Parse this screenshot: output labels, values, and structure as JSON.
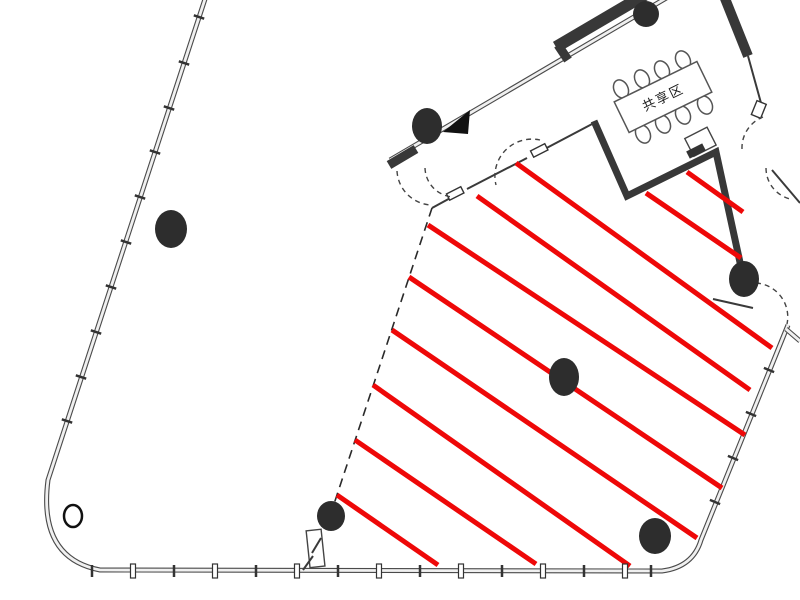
{
  "labels": {
    "shared_area": "共享区"
  },
  "colors": {
    "hatch_red": "#ee0808",
    "wall_dark": "#383838",
    "line_gray": "#4a4a4a",
    "column_fill": "#2d2d2d",
    "tick": "#333333"
  },
  "hatch_region": {
    "line_width": 5,
    "lines": [
      [
        687,
        172,
        743,
        212
      ],
      [
        646,
        193,
        741,
        258
      ],
      [
        516,
        163,
        772,
        348
      ],
      [
        477,
        196,
        750,
        390
      ],
      [
        428,
        225,
        745,
        435
      ],
      [
        409,
        277,
        722,
        488
      ],
      [
        392,
        330,
        697,
        538
      ],
      [
        373,
        385,
        630,
        566
      ],
      [
        355,
        440,
        536,
        564
      ],
      [
        337,
        495,
        438,
        565
      ]
    ]
  },
  "columns": [
    {
      "cx": 171,
      "cy": 229,
      "rx": 16,
      "ry": 19
    },
    {
      "cx": 427,
      "cy": 126,
      "rx": 15,
      "ry": 18
    },
    {
      "cx": 646,
      "cy": 14,
      "rx": 13,
      "ry": 13
    },
    {
      "cx": 564,
      "cy": 377,
      "rx": 15,
      "ry": 19
    },
    {
      "cx": 744,
      "cy": 279,
      "rx": 15,
      "ry": 18
    },
    {
      "cx": 331,
      "cy": 516,
      "rx": 14,
      "ry": 15
    },
    {
      "cx": 655,
      "cy": 536,
      "rx": 16,
      "ry": 18
    }
  ],
  "open_columns": [
    {
      "cx": 73,
      "cy": 516,
      "rx": 9,
      "ry": 11
    }
  ],
  "meeting_table": {
    "cx": 663,
    "cy": 97,
    "w": 92,
    "h": 34,
    "angle": -26
  },
  "chairs": {
    "rx": 7,
    "ry": 9.5,
    "angle": -26,
    "positions": [
      [
        621,
        89
      ],
      [
        642,
        79
      ],
      [
        662,
        70
      ],
      [
        683,
        60
      ],
      [
        643,
        134
      ],
      [
        663,
        124
      ],
      [
        683,
        115
      ],
      [
        705,
        105
      ]
    ]
  },
  "mullion_ticks": {
    "left": {
      "points": [
        [
          199,
          17
        ],
        [
          184,
          63
        ],
        [
          169,
          108
        ],
        [
          155,
          152
        ],
        [
          140,
          197
        ],
        [
          126,
          242
        ],
        [
          111,
          287
        ],
        [
          96,
          332
        ],
        [
          81,
          377
        ],
        [
          67,
          421
        ]
      ],
      "dx": 5.2,
      "dy": 1.7
    },
    "right": {
      "points": [
        [
          715,
          502
        ],
        [
          733,
          458
        ],
        [
          751,
          414
        ],
        [
          769,
          370
        ]
      ],
      "dx": 5.1,
      "dy": 2.1
    },
    "bottom": {
      "xs": [
        92,
        133,
        174,
        215,
        256,
        297,
        338,
        379,
        420,
        461,
        502,
        543,
        584,
        625,
        651
      ],
      "y1": 565,
      "y2": 577
    }
  }
}
